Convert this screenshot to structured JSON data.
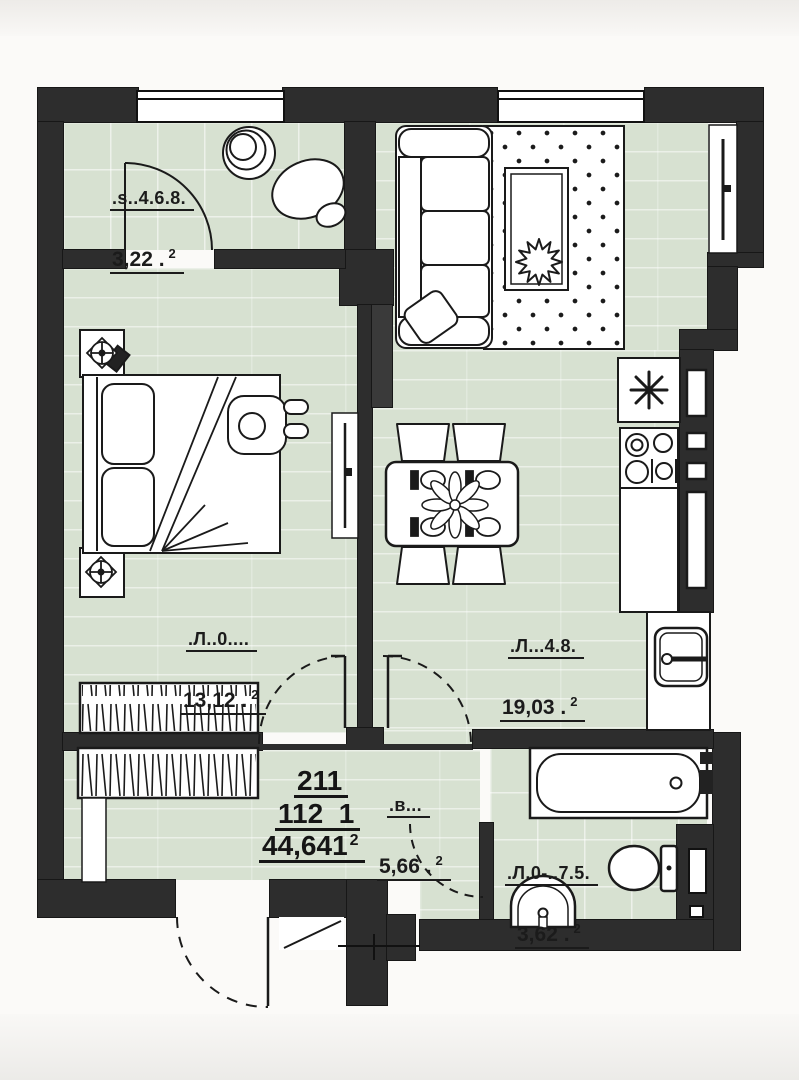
{
  "plan": {
    "rooms": [
      {
        "id": "wc-top",
        "name": ".s..4.6.8.",
        "area": "3,22 .",
        "area_sup": "2"
      },
      {
        "id": "bedroom",
        "name": ".Л..0....",
        "area": "13,12 .",
        "area_sup": "2"
      },
      {
        "id": "kitchen-living",
        "name": ".Л...4.8.",
        "area": "19,03 .",
        "area_sup": "2"
      },
      {
        "id": "hall",
        "name": ".в...",
        "area": "5,66 .",
        "area_sup": "2"
      },
      {
        "id": "bathroom",
        "name": ".Л.0-..7.5.",
        "area": "3,62 .",
        "area_sup": "2"
      }
    ],
    "apartment": {
      "number": "211",
      "code": "112  1",
      "total_area": "44,641",
      "total_area_sup": "2"
    },
    "colors": {
      "wall": "#2d2d2d",
      "floor": "#d7e1d1",
      "ink": "#1a1a1a",
      "paper": "#fbfaf8"
    }
  }
}
